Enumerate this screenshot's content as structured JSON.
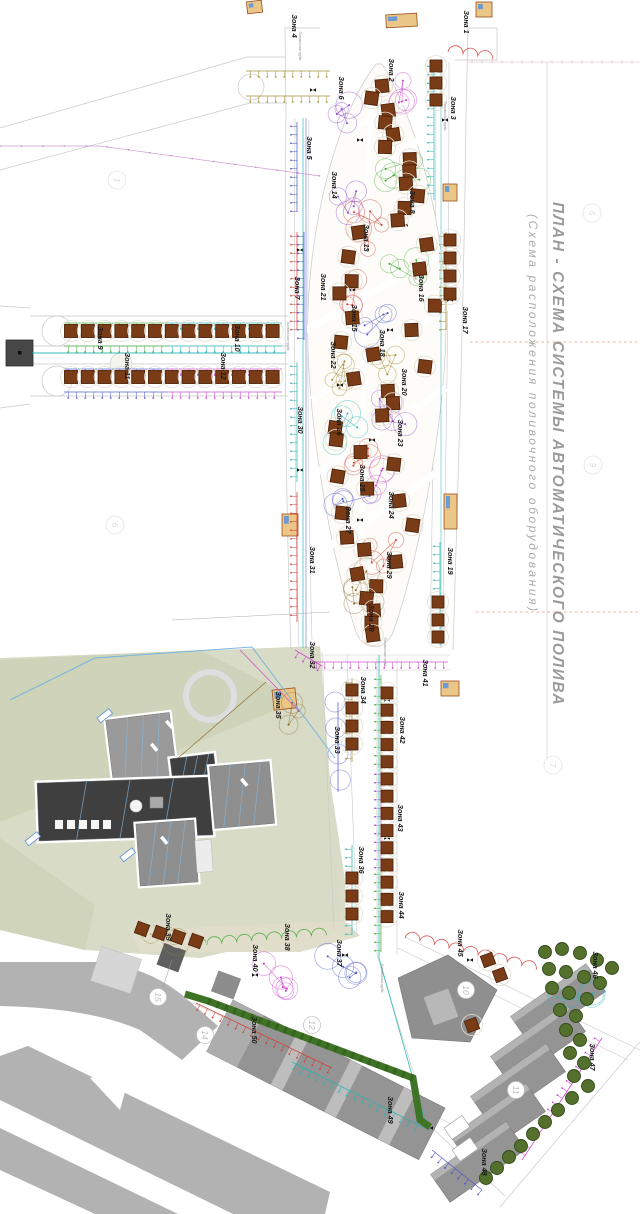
{
  "document": {
    "title": "ПЛАН - СХЕМА СИСТЕМЫ АВТОМАТИЧЕСКОГО ПОЛИВА",
    "subtitle": "(Схема расположения поливочного оборудования)"
  },
  "labels": {
    "pipe_main": "Поливочная труба"
  },
  "pipe_label_positions": [
    {
      "x": 299,
      "y": 46
    },
    {
      "x": 287,
      "y": 336
    },
    {
      "x": 384,
      "y": 652
    },
    {
      "x": 444,
      "y": 116
    },
    {
      "x": 381,
      "y": 978
    }
  ],
  "zones": [
    {
      "id": 1,
      "label": "Зона 1",
      "x": 464,
      "y": 22,
      "color": "red"
    },
    {
      "id": 2,
      "label": "Зона 2",
      "x": 389,
      "y": 70,
      "color": "magenta"
    },
    {
      "id": 3,
      "label": "Зона 3",
      "x": 451,
      "y": 108,
      "color": "cyan"
    },
    {
      "id": 4,
      "label": "Зона 4",
      "x": 292,
      "y": 26,
      "color": "khaki"
    },
    {
      "id": 5,
      "label": "Зона 5",
      "x": 307,
      "y": 148,
      "color": "blue"
    },
    {
      "id": 6,
      "label": "Зона 6",
      "x": 339,
      "y": 88,
      "color": "purple"
    },
    {
      "id": 7,
      "label": "Зона 7",
      "x": 295,
      "y": 288,
      "color": "red"
    },
    {
      "id": 8,
      "label": "Зона 8",
      "x": 410,
      "y": 202,
      "color": "green"
    },
    {
      "id": 9,
      "label": "Зона 9",
      "x": 98,
      "y": 338,
      "color": "green"
    },
    {
      "id": 10,
      "label": "Зона 10",
      "x": 235,
      "y": 338,
      "color": "cyan"
    },
    {
      "id": 11,
      "label": "Зона 11",
      "x": 125,
      "y": 366,
      "color": "blue"
    },
    {
      "id": 12,
      "label": "Зона 12",
      "x": 221,
      "y": 366,
      "color": "magenta"
    },
    {
      "id": 13,
      "label": "Зона 13",
      "x": 364,
      "y": 238,
      "color": "red"
    },
    {
      "id": 14,
      "label": "Зона 14",
      "x": 332,
      "y": 185,
      "color": "purple"
    },
    {
      "id": 15,
      "label": "Зона 15",
      "x": 352,
      "y": 318,
      "color": "red"
    },
    {
      "id": 16,
      "label": "Зона 16",
      "x": 419,
      "y": 288,
      "color": "green"
    },
    {
      "id": 17,
      "label": "Зона 17",
      "x": 463,
      "y": 320,
      "color": "khaki"
    },
    {
      "id": 18,
      "label": "Зона 18",
      "x": 380,
      "y": 343,
      "color": "blue"
    },
    {
      "id": 19,
      "label": "Зона 19",
      "x": 448,
      "y": 561,
      "color": "cyan"
    },
    {
      "id": 20,
      "label": "Зона 20",
      "x": 402,
      "y": 382,
      "color": "khaki"
    },
    {
      "id": 21,
      "label": "Зона 21",
      "x": 321,
      "y": 287,
      "color": "blue"
    },
    {
      "id": 22,
      "label": "Зона 22",
      "x": 331,
      "y": 355,
      "color": "khaki"
    },
    {
      "id": 23,
      "label": "Зона 23",
      "x": 398,
      "y": 433,
      "color": "purple"
    },
    {
      "id": 24,
      "label": "Зона 24",
      "x": 389,
      "y": 505,
      "color": "magenta"
    },
    {
      "id": 25,
      "label": "Зона 25",
      "x": 360,
      "y": 478,
      "color": "red"
    },
    {
      "id": 26,
      "label": "Зона 26",
      "x": 337,
      "y": 422,
      "color": "cyan"
    },
    {
      "id": 27,
      "label": "Зона 27",
      "x": 346,
      "y": 520,
      "color": "blue"
    },
    {
      "id": 28,
      "label": "Зона 28",
      "x": 369,
      "y": 618,
      "color": "brown"
    },
    {
      "id": 29,
      "label": "Зона 29",
      "x": 387,
      "y": 565,
      "color": "red"
    },
    {
      "id": 30,
      "label": "Зона 30",
      "x": 298,
      "y": 420,
      "color": "cyan"
    },
    {
      "id": 31,
      "label": "Зона 31",
      "x": 310,
      "y": 560,
      "color": "red"
    },
    {
      "id": 32,
      "label": "Зона 32",
      "x": 310,
      "y": 655,
      "color": "magenta"
    },
    {
      "id": 33,
      "label": "Зона 33",
      "x": 335,
      "y": 740,
      "color": "blue"
    },
    {
      "id": 34,
      "label": "Зона 34",
      "x": 361,
      "y": 690,
      "color": "khaki"
    },
    {
      "id": 35,
      "label": "Зона 35",
      "x": 276,
      "y": 705,
      "color": "brown"
    },
    {
      "id": 36,
      "label": "Зона 36",
      "x": 359,
      "y": 860,
      "color": "cyan"
    },
    {
      "id": 37,
      "label": "Зона 37",
      "x": 337,
      "y": 953,
      "color": "blue"
    },
    {
      "id": 38,
      "label": "Зона 38",
      "x": 285,
      "y": 937,
      "color": "green"
    },
    {
      "id": 39,
      "label": "Зона 39",
      "x": 166,
      "y": 927,
      "color": "khaki"
    },
    {
      "id": 40,
      "label": "Зона 40",
      "x": 253,
      "y": 958,
      "color": "magenta"
    },
    {
      "id": 41,
      "label": "Зона 41",
      "x": 423,
      "y": 673,
      "color": "magenta"
    },
    {
      "id": 42,
      "label": "Зона 42",
      "x": 400,
      "y": 730,
      "color": "green"
    },
    {
      "id": 43,
      "label": "Зона 43",
      "x": 398,
      "y": 818,
      "color": "purple"
    },
    {
      "id": 44,
      "label": "Зона 44",
      "x": 399,
      "y": 905,
      "color": "green"
    },
    {
      "id": 45,
      "label": "Зона 45",
      "x": 458,
      "y": 943,
      "color": "red"
    },
    {
      "id": 46,
      "label": "Зона 46",
      "x": 593,
      "y": 965,
      "color": "cyan"
    },
    {
      "id": 47,
      "label": "Зона 47",
      "x": 590,
      "y": 1057,
      "color": "magenta"
    },
    {
      "id": 48,
      "label": "Зона 48",
      "x": 482,
      "y": 1162,
      "color": "blue"
    },
    {
      "id": 49,
      "label": "Зона 49",
      "x": 388,
      "y": 1110,
      "color": "cyan"
    },
    {
      "id": 50,
      "label": "Зона 50",
      "x": 252,
      "y": 1030,
      "color": "red"
    }
  ],
  "building_numbers": [
    {
      "label": "15",
      "x": 158,
      "y": 997
    },
    {
      "label": "14",
      "x": 205,
      "y": 1035
    },
    {
      "label": "12",
      "x": 312,
      "y": 1025
    },
    {
      "label": "10",
      "x": 466,
      "y": 990
    },
    {
      "label": "11",
      "x": 516,
      "y": 1090
    }
  ],
  "grid_markers": [
    {
      "label": "1",
      "x": 117,
      "y": 180
    },
    {
      "label": "5",
      "x": 592,
      "y": 213
    },
    {
      "label": "9",
      "x": 593,
      "y": 465
    },
    {
      "label": "6",
      "x": 115,
      "y": 525
    },
    {
      "label": "7",
      "x": 553,
      "y": 765
    }
  ],
  "palette": {
    "red": "#d63a30",
    "green": "#3faa35",
    "cyan": "#22b5b5",
    "magenta": "#c93ec9",
    "blue": "#4953c8",
    "purple": "#8e44c8",
    "khaki": "#a08830",
    "brown": "#8a6b2a",
    "lawn": "#d8dbc6",
    "lawn_dark": "#cdd1b6",
    "road": "#b2b2b2",
    "curb": "#c9c9c9",
    "building_dark": "#3f3f3f",
    "building_mid": "#8f8f8f",
    "building_light": "#b5b5b5",
    "tree_brown": "#7a3c17",
    "tree_green": "#55702c",
    "kiosk": "#eac687",
    "title_gray": "#9b9b9b"
  }
}
